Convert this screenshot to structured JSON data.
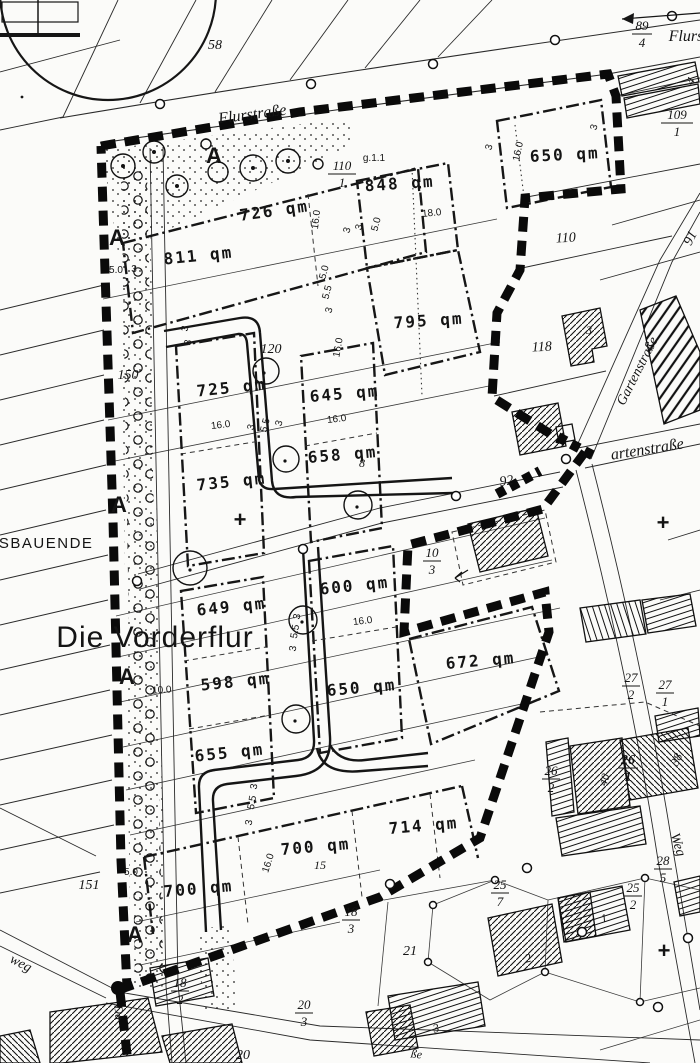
{
  "labels": {
    "big": {
      "vorderflur": "Die Vorderflur",
      "ausbauende": "USBAUENDE"
    },
    "streets": {
      "flurstrasse": "Flurstraße",
      "flurs": "Flurs",
      "gartenstrasse": "Gartenstraße",
      "artenstrasse": "artenstraße",
      "weg": "Weg",
      "weg_sw": "weg",
      "da": "Da",
      "sse": "ße"
    },
    "areas": [
      "650 qm",
      "726 qm",
      "848 qm",
      "811 qm",
      "795 qm",
      "725 qm",
      "645 qm",
      "658 qm",
      "735 qm",
      "600 qm",
      "649 qm",
      "672 qm",
      "598 qm",
      "650 qm",
      "655 qm",
      "714 qm",
      "700 qm",
      "700 qm"
    ],
    "numbers": {
      "n58": "58",
      "n91": "91",
      "n92": "92",
      "n110": "110",
      "n118": "118",
      "n120": "120",
      "n150": "150",
      "n151": "151",
      "n21": "21",
      "n20": "20",
      "n15": "15",
      "n8": "8",
      "g11": "g.1.1"
    },
    "fractions": {
      "f89_4": {
        "n": "89",
        "d": "4"
      },
      "f109_1": {
        "n": "109",
        "d": "1"
      },
      "f110_1": {
        "n": "110",
        "d": "1"
      },
      "f10_3": {
        "n": "10",
        "d": "3"
      },
      "f27_2": {
        "n": "27",
        "d": "2"
      },
      "f27_1": {
        "n": "27",
        "d": "1"
      },
      "f26_2": {
        "n": "26",
        "d": "2"
      },
      "f26_1": {
        "n": "26",
        "d": "1"
      },
      "f28_5": {
        "n": "28",
        "d": "5"
      },
      "f25_7": {
        "n": "25",
        "d": "7"
      },
      "f25_2": {
        "n": "25",
        "d": "2"
      },
      "f20_3": {
        "n": "20",
        "d": "3"
      },
      "f18_2": {
        "n": "18",
        "d": "2"
      },
      "f18_3": {
        "n": "18",
        "d": "3"
      }
    },
    "dims": {
      "d16": "16.0",
      "d18": "18.0",
      "d10": "10.0",
      "d5": "5.0",
      "d55": "5.5",
      "d3": "3"
    },
    "marks": {
      "a": "A",
      "plus": "+"
    },
    "building_numbers": {
      "b1": "1",
      "b2": "2",
      "b3": "3",
      "b4": "4",
      "b38": "38",
      "b40": "40"
    }
  }
}
